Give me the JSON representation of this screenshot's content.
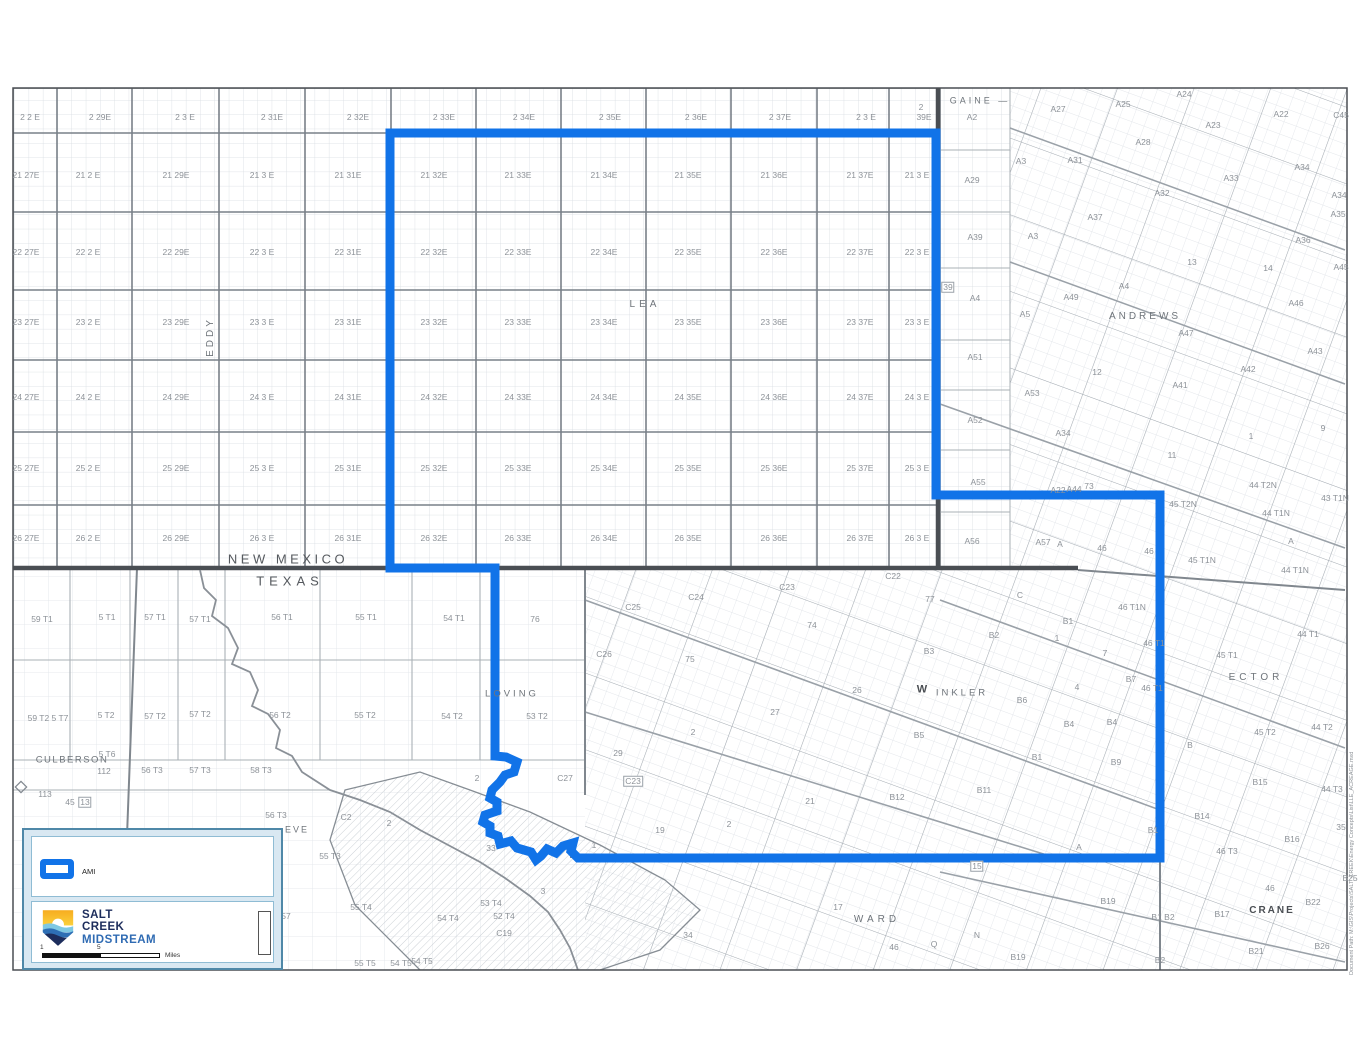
{
  "colors": {
    "ami_blue": "#1173e8",
    "state_line": "#4a4e53",
    "county_line": "#80878e",
    "grid_major": "#798088",
    "grid_fine": "#d8dde2",
    "label_gray": "#8d9298",
    "county_gray": "#6f757b",
    "legend_border": "#4f88a8",
    "legend_inner_border": "#8fbcd4",
    "logo_navy": "#1d2d5c",
    "logo_blue": "#2f6bb3",
    "logo_yellow": "#f6a81c"
  },
  "legend": {
    "ami_label": "AMI",
    "company_line1": "SALT",
    "company_line2": "CREEK",
    "company_line3": "MIDSTREAM",
    "scale_start": "1",
    "scale_mid": "5",
    "scale_unit": "Miles"
  },
  "footer_note": "Document Path: M:\\GIS\\Projects\\SALT_CREEK\\Energy Concepts\\List\\LLE_ACREAGE.mxd",
  "map": {
    "nm_grid": {
      "col_x": [
        26,
        88,
        176,
        262,
        348,
        434,
        518,
        604,
        688,
        774,
        860,
        917
      ],
      "rows": [
        {
          "y": 117,
          "xs": [
            30,
            100,
            185,
            272,
            358,
            444,
            524,
            610,
            696,
            780,
            866
          ],
          "cells": [
            "2 2 E",
            "2 29E",
            "2 3 E",
            "2 31E",
            "2 32E",
            "2 33E",
            "2 34E",
            "2 35E",
            "2 36E",
            "2 37E",
            "2 3 E"
          ]
        },
        {
          "y": 175,
          "cells": [
            "21 27E",
            "21 2 E",
            "21 29E",
            "21 3 E",
            "21 31E",
            "21 32E",
            "21 33E",
            "21 34E",
            "21 35E",
            "21 36E",
            "21  37E",
            "21 3 E"
          ]
        },
        {
          "y": 252,
          "cells": [
            "22 27E",
            "22 2 E",
            "22 29E",
            "22 3 E",
            "22 31E",
            "22 32E",
            "22 33E",
            "22 34E",
            "22 35E",
            "22 36E",
            "22 37E",
            "22 3 E"
          ]
        },
        {
          "y": 322,
          "cells": [
            "23 27E",
            "23 2 E",
            "23 29E",
            "23 3 E",
            "23 31E",
            "23 32E",
            "23 33E",
            "23 34E",
            "23 35E",
            "23 36E",
            "23 37E",
            "23 3 E"
          ]
        },
        {
          "y": 397,
          "cells": [
            "24 27E",
            "24 2 E",
            "24 29E",
            "24 3 E",
            "24 31E",
            "24 32E",
            "24 33E",
            "24 34E",
            "24 35E",
            "24 36E",
            "24 37E",
            "24 3 E"
          ]
        },
        {
          "y": 468,
          "cells": [
            "25 27E",
            "25 2 E",
            "25 29E",
            "25 3 E",
            "25 31E",
            "25  32E",
            "25 33E",
            "25 34E",
            "25 35E",
            "25 36E",
            "25 37E",
            "25 3 E"
          ]
        },
        {
          "y": 538,
          "cells": [
            "26 27E",
            "26 2 E",
            "26 29E",
            "26 3 E",
            "26 31E",
            "26 32E",
            "26 33E",
            "26 34E",
            "26 35E",
            "26 36E",
            "26 37E",
            "26 3 E"
          ]
        }
      ]
    },
    "labels": [
      {
        "t": "2",
        "x": 921,
        "y": 107
      },
      {
        "t": "39E",
        "x": 924,
        "y": 117
      },
      {
        "t": "GAINE  —",
        "x": 980,
        "y": 101,
        "s": 9,
        "ls": 3,
        "c": "#6f757b"
      },
      {
        "t": "EDDY",
        "x": 211,
        "y": 337,
        "s": 10,
        "ls": 3,
        "r": -90,
        "c": "#6f757b"
      },
      {
        "t": "LEA",
        "x": 645,
        "y": 305,
        "s": 10,
        "ls": 4,
        "c": "#6f757b"
      },
      {
        "t": "NEW MEXICO",
        "x": 288,
        "y": 559,
        "s": 13,
        "ls": 3.5,
        "c": "#55595e"
      },
      {
        "t": "TEXAS",
        "x": 290,
        "y": 581,
        "s": 13,
        "ls": 5,
        "c": "#55595e"
      },
      {
        "t": "ANDREWS",
        "x": 1145,
        "y": 317,
        "s": 10,
        "ls": 3,
        "c": "#6f757b"
      },
      {
        "t": "LOVING",
        "x": 512,
        "y": 694,
        "s": 9.5,
        "ls": 3,
        "c": "#6f757b"
      },
      {
        "t": "CULBERSON",
        "x": 72,
        "y": 760,
        "s": 9.5,
        "ls": 1.5,
        "c": "#6f757b"
      },
      {
        "t": "W",
        "x": 922,
        "y": 690,
        "s": 11,
        "b": 1,
        "c": "#4a4e53"
      },
      {
        "t": "INKLER",
        "x": 962,
        "y": 693,
        "s": 9.5,
        "ls": 3,
        "c": "#6f757b"
      },
      {
        "t": "ECTOR",
        "x": 1256,
        "y": 678,
        "s": 10,
        "ls": 4,
        "c": "#6f757b"
      },
      {
        "t": "WARD",
        "x": 877,
        "y": 920,
        "s": 10,
        "ls": 4,
        "c": "#6f757b"
      },
      {
        "t": "CRANE",
        "x": 1272,
        "y": 911,
        "s": 10,
        "ls": 2,
        "b": 1,
        "c": "#4a4e53"
      },
      {
        "t": "EVE",
        "x": 297,
        "y": 830,
        "s": 9,
        "ls": 2,
        "c": "#6f757b"
      },
      {
        "t": "A2",
        "x": 972,
        "y": 117
      },
      {
        "t": "A29",
        "x": 972,
        "y": 180
      },
      {
        "t": "A39",
        "x": 975,
        "y": 237
      },
      {
        "t": "39",
        "x": 948,
        "y": 287,
        "box": 1
      },
      {
        "t": "A4",
        "x": 975,
        "y": 298
      },
      {
        "t": "A51",
        "x": 975,
        "y": 357
      },
      {
        "t": "A52",
        "x": 975,
        "y": 420
      },
      {
        "t": "A55",
        "x": 978,
        "y": 482
      },
      {
        "t": "A56",
        "x": 972,
        "y": 541
      },
      {
        "t": "A27",
        "x": 1058,
        "y": 109
      },
      {
        "t": "A25",
        "x": 1123,
        "y": 104
      },
      {
        "t": "A24",
        "x": 1184,
        "y": 94
      },
      {
        "t": "A23",
        "x": 1213,
        "y": 125
      },
      {
        "t": "A22",
        "x": 1281,
        "y": 114
      },
      {
        "t": "C45",
        "x": 1341,
        "y": 115
      },
      {
        "t": "A28",
        "x": 1143,
        "y": 142
      },
      {
        "t": "A3",
        "x": 1021,
        "y": 161
      },
      {
        "t": "A31",
        "x": 1075,
        "y": 160
      },
      {
        "t": "A32",
        "x": 1162,
        "y": 193
      },
      {
        "t": "A33",
        "x": 1231,
        "y": 178
      },
      {
        "t": "A34",
        "x": 1302,
        "y": 167
      },
      {
        "t": "A34",
        "x": 1339,
        "y": 195
      },
      {
        "t": "A35",
        "x": 1338,
        "y": 214
      },
      {
        "t": "A37",
        "x": 1095,
        "y": 217
      },
      {
        "t": "A3",
        "x": 1033,
        "y": 236
      },
      {
        "t": "A36",
        "x": 1303,
        "y": 240
      },
      {
        "t": "13",
        "x": 1192,
        "y": 262
      },
      {
        "t": "14",
        "x": 1268,
        "y": 268
      },
      {
        "t": "A45",
        "x": 1341,
        "y": 267
      },
      {
        "t": "A4",
        "x": 1124,
        "y": 286
      },
      {
        "t": "A49",
        "x": 1071,
        "y": 297
      },
      {
        "t": "A46",
        "x": 1296,
        "y": 303
      },
      {
        "t": "A5",
        "x": 1025,
        "y": 314
      },
      {
        "t": "A47",
        "x": 1186,
        "y": 333
      },
      {
        "t": "A43",
        "x": 1315,
        "y": 351
      },
      {
        "t": "A42",
        "x": 1248,
        "y": 369
      },
      {
        "t": "12",
        "x": 1097,
        "y": 372
      },
      {
        "t": "A41",
        "x": 1180,
        "y": 385
      },
      {
        "t": "A53",
        "x": 1032,
        "y": 393
      },
      {
        "t": "A34",
        "x": 1063,
        "y": 433
      },
      {
        "t": "9",
        "x": 1323,
        "y": 428
      },
      {
        "t": "1",
        "x": 1251,
        "y": 436
      },
      {
        "t": "11",
        "x": 1172,
        "y": 455
      },
      {
        "t": "A22",
        "x": 1058,
        "y": 490
      },
      {
        "t": "A44",
        "x": 1074,
        "y": 489
      },
      {
        "t": "73",
        "x": 1089,
        "y": 486
      },
      {
        "t": "44 T2N",
        "x": 1263,
        "y": 485
      },
      {
        "t": "45 T2N",
        "x": 1183,
        "y": 504
      },
      {
        "t": "43 T1N",
        "x": 1335,
        "y": 498
      },
      {
        "t": "44 T1N",
        "x": 1276,
        "y": 513
      },
      {
        "t": "A",
        "x": 1291,
        "y": 541
      },
      {
        "t": "A57",
        "x": 1043,
        "y": 542
      },
      {
        "t": "A",
        "x": 1060,
        "y": 544
      },
      {
        "t": "46",
        "x": 1102,
        "y": 548
      },
      {
        "t": "46",
        "x": 1149,
        "y": 551
      },
      {
        "t": "45 T1N",
        "x": 1202,
        "y": 560
      },
      {
        "t": "44 T1N",
        "x": 1295,
        "y": 570
      },
      {
        "t": "46 T1N",
        "x": 1132,
        "y": 607
      },
      {
        "t": "C",
        "x": 1020,
        "y": 595
      },
      {
        "t": "C22",
        "x": 893,
        "y": 576
      },
      {
        "t": "C23",
        "x": 787,
        "y": 587
      },
      {
        "t": "C24",
        "x": 696,
        "y": 597
      },
      {
        "t": "C25",
        "x": 633,
        "y": 607
      },
      {
        "t": "C26",
        "x": 604,
        "y": 654
      },
      {
        "t": "77",
        "x": 930,
        "y": 599
      },
      {
        "t": "74",
        "x": 812,
        "y": 625
      },
      {
        "t": "75",
        "x": 690,
        "y": 659
      },
      {
        "t": "26",
        "x": 857,
        "y": 690
      },
      {
        "t": "27",
        "x": 775,
        "y": 712
      },
      {
        "t": "2",
        "x": 693,
        "y": 732
      },
      {
        "t": "29",
        "x": 618,
        "y": 753
      },
      {
        "t": "C27",
        "x": 565,
        "y": 778
      },
      {
        "t": "C23",
        "x": 633,
        "y": 781,
        "box": 1
      },
      {
        "t": "19",
        "x": 660,
        "y": 830
      },
      {
        "t": "2",
        "x": 729,
        "y": 824
      },
      {
        "t": "21",
        "x": 810,
        "y": 801
      },
      {
        "t": "1",
        "x": 594,
        "y": 845
      },
      {
        "t": "2",
        "x": 477,
        "y": 778
      },
      {
        "t": "33",
        "x": 491,
        "y": 848
      },
      {
        "t": "3",
        "x": 543,
        "y": 891
      },
      {
        "t": "B1",
        "x": 1068,
        "y": 621
      },
      {
        "t": "B2",
        "x": 994,
        "y": 635
      },
      {
        "t": "B3",
        "x": 929,
        "y": 651
      },
      {
        "t": "1",
        "x": 1057,
        "y": 638
      },
      {
        "t": "7",
        "x": 1105,
        "y": 653
      },
      {
        "t": "B7",
        "x": 1131,
        "y": 679
      },
      {
        "t": "4",
        "x": 1077,
        "y": 687
      },
      {
        "t": "B6",
        "x": 1022,
        "y": 700
      },
      {
        "t": "B4",
        "x": 1069,
        "y": 724
      },
      {
        "t": "B4",
        "x": 1112,
        "y": 722
      },
      {
        "t": "B5",
        "x": 919,
        "y": 735
      },
      {
        "t": "B1",
        "x": 1037,
        "y": 757
      },
      {
        "t": "B9",
        "x": 1116,
        "y": 762
      },
      {
        "t": "B11",
        "x": 984,
        "y": 790
      },
      {
        "t": "B12",
        "x": 897,
        "y": 797
      },
      {
        "t": "A",
        "x": 1079,
        "y": 847
      },
      {
        "t": "B1",
        "x": 1153,
        "y": 830
      },
      {
        "t": "B",
        "x": 1190,
        "y": 745
      },
      {
        "t": "B15",
        "x": 1260,
        "y": 782
      },
      {
        "t": "B14",
        "x": 1202,
        "y": 816
      },
      {
        "t": "B16",
        "x": 1292,
        "y": 839
      },
      {
        "t": "44 T1",
        "x": 1308,
        "y": 634
      },
      {
        "t": "45 T1",
        "x": 1227,
        "y": 655
      },
      {
        "t": "46 T1",
        "x": 1154,
        "y": 643
      },
      {
        "t": "46 T1",
        "x": 1152,
        "y": 688
      },
      {
        "t": "44 T2",
        "x": 1322,
        "y": 727
      },
      {
        "t": "45 T2",
        "x": 1265,
        "y": 732
      },
      {
        "t": "44 T3",
        "x": 1332,
        "y": 789
      },
      {
        "t": "35",
        "x": 1341,
        "y": 827
      },
      {
        "t": "46 T3",
        "x": 1227,
        "y": 851
      },
      {
        "t": "B25",
        "x": 1350,
        "y": 878
      },
      {
        "t": "15",
        "x": 977,
        "y": 866,
        "box": 1
      },
      {
        "t": "17",
        "x": 838,
        "y": 907
      },
      {
        "t": "34",
        "x": 688,
        "y": 935
      },
      {
        "t": "46",
        "x": 894,
        "y": 947
      },
      {
        "t": "Q",
        "x": 934,
        "y": 944
      },
      {
        "t": "N",
        "x": 977,
        "y": 935
      },
      {
        "t": "B19",
        "x": 1108,
        "y": 901
      },
      {
        "t": "B19",
        "x": 1018,
        "y": 957
      },
      {
        "t": "B1 B2",
        "x": 1163,
        "y": 917
      },
      {
        "t": "B17",
        "x": 1222,
        "y": 914
      },
      {
        "t": "46",
        "x": 1270,
        "y": 888
      },
      {
        "t": "B22",
        "x": 1313,
        "y": 902
      },
      {
        "t": "B21",
        "x": 1256,
        "y": 951
      },
      {
        "t": "B26",
        "x": 1322,
        "y": 946
      },
      {
        "t": "B2",
        "x": 1160,
        "y": 960
      },
      {
        "t": "59 T1",
        "x": 42,
        "y": 619
      },
      {
        "t": "5 T1",
        "x": 107,
        "y": 617
      },
      {
        "t": "57 T1",
        "x": 155,
        "y": 617
      },
      {
        "t": "57 T1",
        "x": 200,
        "y": 619
      },
      {
        "t": "56 T1",
        "x": 282,
        "y": 617
      },
      {
        "t": "55 T1",
        "x": 366,
        "y": 617
      },
      {
        "t": "54 T1",
        "x": 454,
        "y": 618
      },
      {
        "t": "76",
        "x": 535,
        "y": 619
      },
      {
        "t": "59 T2 5 T7",
        "x": 48,
        "y": 718
      },
      {
        "t": "5 T2",
        "x": 106,
        "y": 715
      },
      {
        "t": "57 T2",
        "x": 155,
        "y": 716
      },
      {
        "t": "57 T2",
        "x": 200,
        "y": 714
      },
      {
        "t": "56 T2",
        "x": 280,
        "y": 715
      },
      {
        "t": "55 T2",
        "x": 365,
        "y": 715
      },
      {
        "t": "54 T2",
        "x": 452,
        "y": 716
      },
      {
        "t": "53 T2",
        "x": 537,
        "y": 716
      },
      {
        "t": "5 T6",
        "x": 107,
        "y": 754
      },
      {
        "t": "112",
        "x": 104,
        "y": 771
      },
      {
        "t": "56 T3",
        "x": 152,
        "y": 770
      },
      {
        "t": "57 T3",
        "x": 200,
        "y": 770
      },
      {
        "t": "58 T3",
        "x": 261,
        "y": 770
      },
      {
        "t": "113",
        "x": 45,
        "y": 794
      },
      {
        "t": "45",
        "x": 70,
        "y": 802
      },
      {
        "t": "13",
        "x": 85,
        "y": 802,
        "box": 1
      },
      {
        "t": "56 T3",
        "x": 276,
        "y": 815
      },
      {
        "t": "C2",
        "x": 346,
        "y": 817
      },
      {
        "t": "2",
        "x": 389,
        "y": 823
      },
      {
        "t": "55 T3",
        "x": 330,
        "y": 856
      },
      {
        "t": "57",
        "x": 286,
        "y": 916
      },
      {
        "t": "55 T4",
        "x": 361,
        "y": 907
      },
      {
        "t": "54 T4",
        "x": 448,
        "y": 918
      },
      {
        "t": "53 T4",
        "x": 491,
        "y": 903
      },
      {
        "t": "52 T4",
        "x": 504,
        "y": 916
      },
      {
        "t": "C19",
        "x": 504,
        "y": 933
      },
      {
        "t": "55 T5",
        "x": 365,
        "y": 963
      },
      {
        "t": "54 T5",
        "x": 401,
        "y": 963
      },
      {
        "t": "54 T5",
        "x": 422,
        "y": 961
      }
    ]
  }
}
